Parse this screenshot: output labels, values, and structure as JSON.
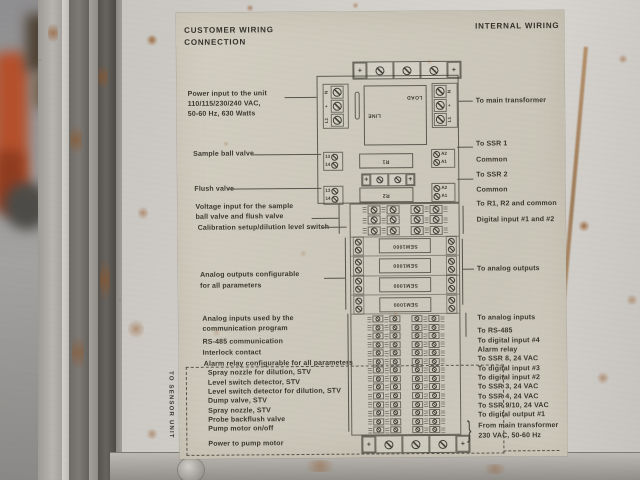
{
  "label": {
    "header_left_line1": "CUSTOMER WIRING",
    "header_left_line2": "CONNECTION",
    "header_right": "INTERNAL WIRING",
    "left": {
      "power1": "Power input to the unit",
      "power2": "110/115/230/240 VAC,",
      "power3": "50-60 Hz, 630 Watts",
      "sample": "Sample ball valve",
      "flush": "Flush valve",
      "voltage1": "Voltage input for the sample",
      "voltage2": "ball valve and flush valve",
      "calibration": "Calibration setup/dilution level switch",
      "analog_out1": "Analog outputs configurable",
      "analog_out2": "for all parameters",
      "analog_in1": "Analog inputs used by the",
      "analog_in2": "communication program",
      "rs485": "RS-485 communication",
      "interlock": "Interlock contact",
      "alarm": "Alarm relay configurable for all parameters"
    },
    "sensor": {
      "title": "TO SENSOR UNIT",
      "items": [
        "Spray nozzle for dilution, STV",
        "Level switch detector, STV",
        "Level switch detector for dilution, STV",
        "Dump valve, STV",
        "Spray nozzle, STV",
        "Probe backflush valve",
        "Pump motor on/off"
      ],
      "power": "Power to pump motor"
    },
    "right": {
      "transformer": "To main transformer",
      "ssr1": "To SSR 1",
      "common1": "Common",
      "ssr2": "To SSR 2",
      "common2": "Common",
      "r1r2": "To R1, R2 and common",
      "digital12": "Digital input #1 and #2",
      "analog_out": "To analog outputs",
      "analog_in": "To analog inputs",
      "rs485": "To RS-485",
      "digital4": "To digital input #4",
      "alarm": "Alarm relay",
      "ssr8": "To SSR 8, 24 VAC",
      "digital3": "To digital input #3",
      "digital2": "To digital input #2",
      "ssr3": "To SSR 3, 24 VAC",
      "ssr4": "To SSR 4, 24 VAC",
      "ssr910": "To SSR 9/10, 24 VAC",
      "digital_out1": "To digital output #1",
      "from_main1": "From main transformer",
      "from_main2": "230 VAC, 50-60 Hz"
    },
    "diagram": {
      "line_label": "LINE",
      "load_label": "LOAD",
      "terminals_left_0": "N",
      "terminals_left_1": "+",
      "terminals_left_2": "L1",
      "terminals_right_0": "N",
      "terminals_right_1": "+",
      "terminals_right_2": "L1",
      "relay1": "R1",
      "relay2": "R2",
      "contact_a": "13",
      "contact_b": "14",
      "coil_a": "A2",
      "coil_b": "A1",
      "isolator": "SEM1000",
      "brace": "}"
    },
    "colors": {
      "label_bg": "#ccc8bb",
      "panel_metal": "#d3d0cb",
      "print_ink": "#3a382f",
      "rust": "#925526"
    }
  }
}
